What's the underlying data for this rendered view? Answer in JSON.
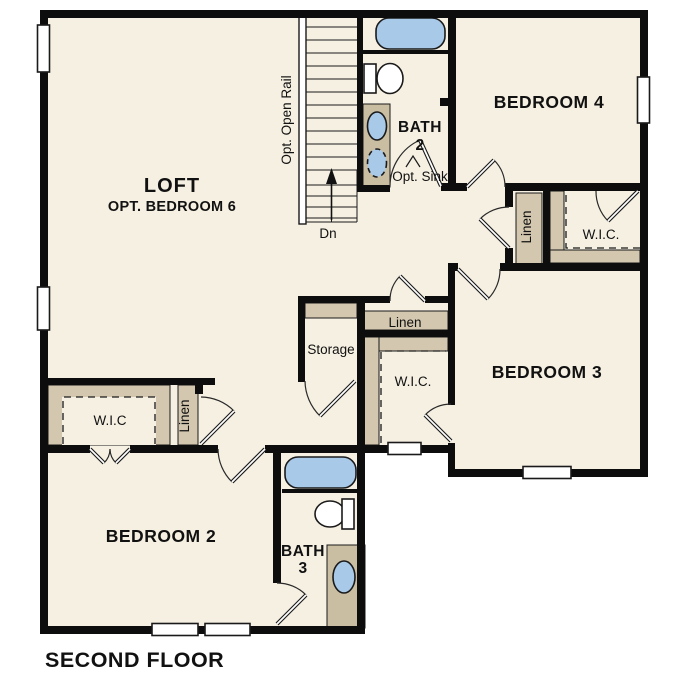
{
  "plan": {
    "title": "SECOND FLOOR",
    "rooms": {
      "loft": {
        "name": "LOFT",
        "subtitle": "OPT. BEDROOM 6"
      },
      "bedroom4": {
        "name": "BEDROOM 4"
      },
      "bedroom3": {
        "name": "BEDROOM 3"
      },
      "bedroom2": {
        "name": "BEDROOM 2"
      },
      "bath2": {
        "line1": "BATH",
        "line2": "2",
        "note": "Opt. Sink"
      },
      "bath3": {
        "line1": "BATH",
        "line2": "3"
      },
      "storage": {
        "name": "Storage"
      }
    },
    "closets": {
      "linen_middle": "Linen",
      "linen_right": "Linen",
      "linen_left": "Linen",
      "wic_left": "W.I.C",
      "wic_middle": "W.I.C.",
      "wic_right": "W.I.C."
    },
    "stairs": {
      "rail_label": "Opt. Open Rail",
      "down_label": "Dn"
    },
    "colors": {
      "floor": "#f6f0e2",
      "wall": "#0d0d0d",
      "casework": "#d3c7af",
      "vanity": "#c9bda2",
      "fixture_blue": "#a9c9e9",
      "outside": "#ffffff"
    }
  }
}
